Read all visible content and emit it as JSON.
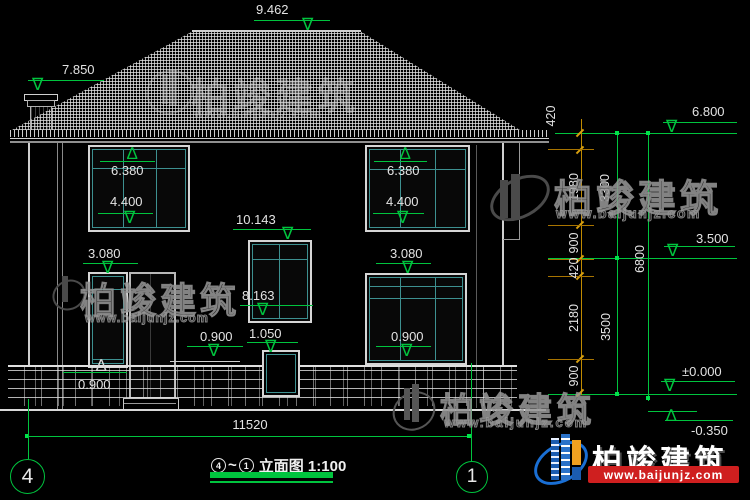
{
  "drawing": {
    "title": {
      "axis_from": "4",
      "tilde": "~",
      "axis_to": "1",
      "name_and_scale": "立面图 1:100"
    },
    "axes": {
      "left_bubble": "4",
      "right_bubble": "1"
    },
    "bottom_dim": "11520",
    "levels": {
      "ridge": "9.462",
      "chimney": "7.850",
      "eave": "6.800",
      "win2_top_left": "6.380",
      "win2_sill_left": "4.400",
      "win2_top_right": "6.380",
      "win2_sill_right": "4.400",
      "stair_win_top": "10.143",
      "stair_win_sill": "8.163",
      "gf_win_top_left": "3.080",
      "gf_win_top_right": "3.080",
      "porch_mid": "0.900",
      "gf_sill_right": "0.900",
      "porch_left": "0.900",
      "stair_small_win": "1.050",
      "second_floor": "3.500",
      "ground": "±0.000",
      "grade": "-0.350"
    },
    "chain_inner": [
      "420",
      "1980",
      "900",
      "420",
      "2180",
      "900"
    ],
    "chain_mid": [
      "3300",
      "3500"
    ],
    "chain_outer": "6800"
  },
  "watermark": {
    "brand": "柏竣建筑",
    "url": "www.baijunjz.com"
  },
  "logo": {
    "brand": "柏竣建筑",
    "url": "www.baijunjz.com"
  },
  "colors": {
    "dim_green": "#00c43e",
    "chain_orange": "#c08a00",
    "window_teal": "#3d9090",
    "logo_red": "#cf1f1f",
    "logo_blue": "#1b5cb0",
    "logo_orange": "#f0a020"
  }
}
